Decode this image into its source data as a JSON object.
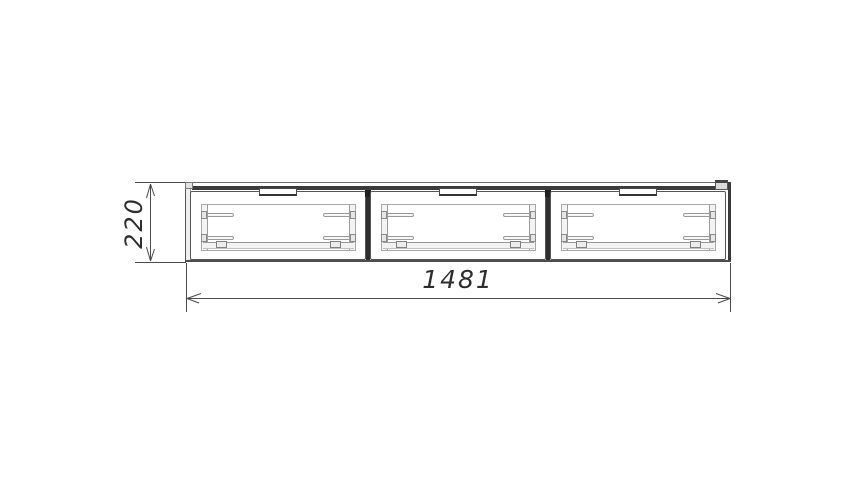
{
  "drawing": {
    "compartment_count": 3,
    "dimensions": {
      "width": {
        "value": "1481"
      },
      "height": {
        "value": "220"
      }
    },
    "colors": {
      "outline_dark": "#3b3b3b",
      "outline_medium": "#666666",
      "outline_light": "#aaaaaa",
      "dimension_line": "#4a4a4a",
      "dimension_text": "#2e2e2e",
      "background": "#ffffff"
    }
  }
}
